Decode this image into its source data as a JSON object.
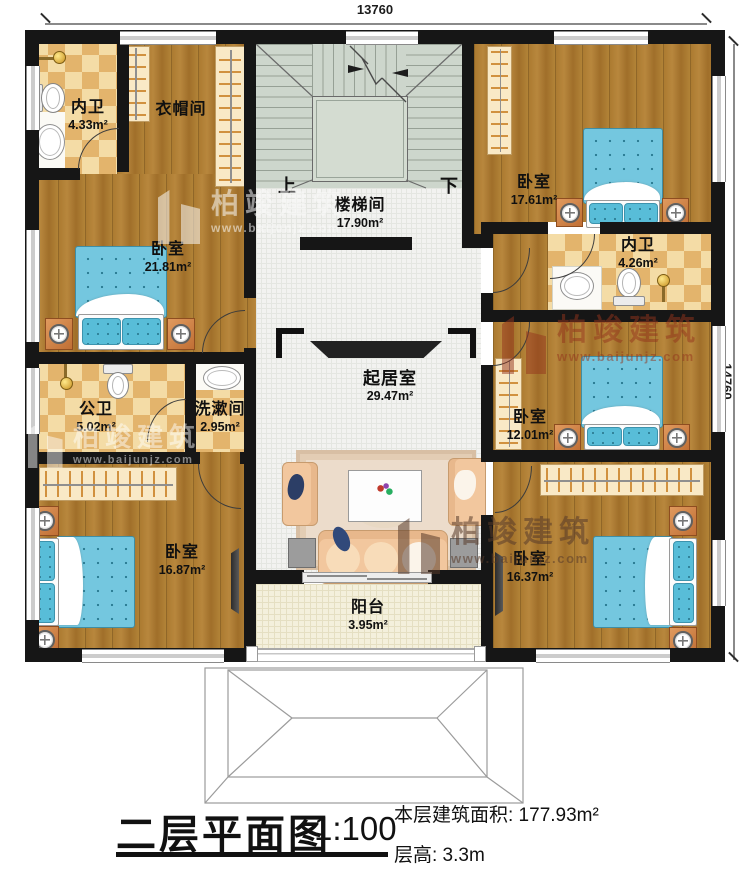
{
  "dimensions": {
    "top": "13760",
    "right": "14760"
  },
  "rooms": {
    "bath_tl": {
      "name": "内卫",
      "area": "4.33m²"
    },
    "closet": {
      "name": "衣帽间"
    },
    "bedroom_left": {
      "name": "卧室",
      "area": "21.81m²"
    },
    "public_bath": {
      "name": "公卫",
      "area": "5.02m²"
    },
    "washroom": {
      "name": "洗漱间",
      "area": "2.95m²"
    },
    "bedroom_bl": {
      "name": "卧室",
      "area": "16.87m²"
    },
    "stairwell": {
      "name": "楼梯间",
      "area": "17.90m²"
    },
    "living": {
      "name": "起居室",
      "area": "29.47m²"
    },
    "balcony": {
      "name": "阳台",
      "area": "3.95m²"
    },
    "bedroom_tr": {
      "name": "卧室",
      "area": "17.61m²"
    },
    "bath_right": {
      "name": "内卫",
      "area": "4.26m²"
    },
    "bedroom_mr": {
      "name": "卧室",
      "area": "12.01m²"
    },
    "bedroom_br": {
      "name": "卧室",
      "area": "16.37m²"
    }
  },
  "stairs": {
    "up": "上",
    "down": "下"
  },
  "watermark": {
    "brand": "柏竣建筑",
    "url": "www.baijunjz.com"
  },
  "title": {
    "plan": "二层平面图",
    "scale": "1:100",
    "floor_area": "本层建筑面积: 177.93m²",
    "floor_height": "层高: 3.3m"
  },
  "colors": {
    "wall": "#161616",
    "wood": "#ab7b32",
    "tile_light": "#f4dca6",
    "tile_dark": "#e3b46c",
    "stair": "#cdd6cc",
    "mattress": "#74c7df"
  }
}
